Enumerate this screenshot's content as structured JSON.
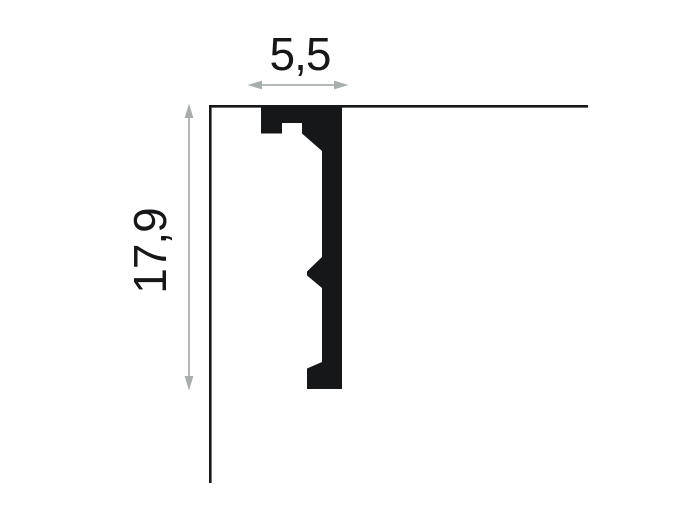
{
  "diagram": {
    "type": "molding-profile-cross-section",
    "width_label": "5,5",
    "height_label": "17,9",
    "colors": {
      "ink": "#161719",
      "arrow": "#a7afae",
      "background": "#ffffff"
    }
  }
}
